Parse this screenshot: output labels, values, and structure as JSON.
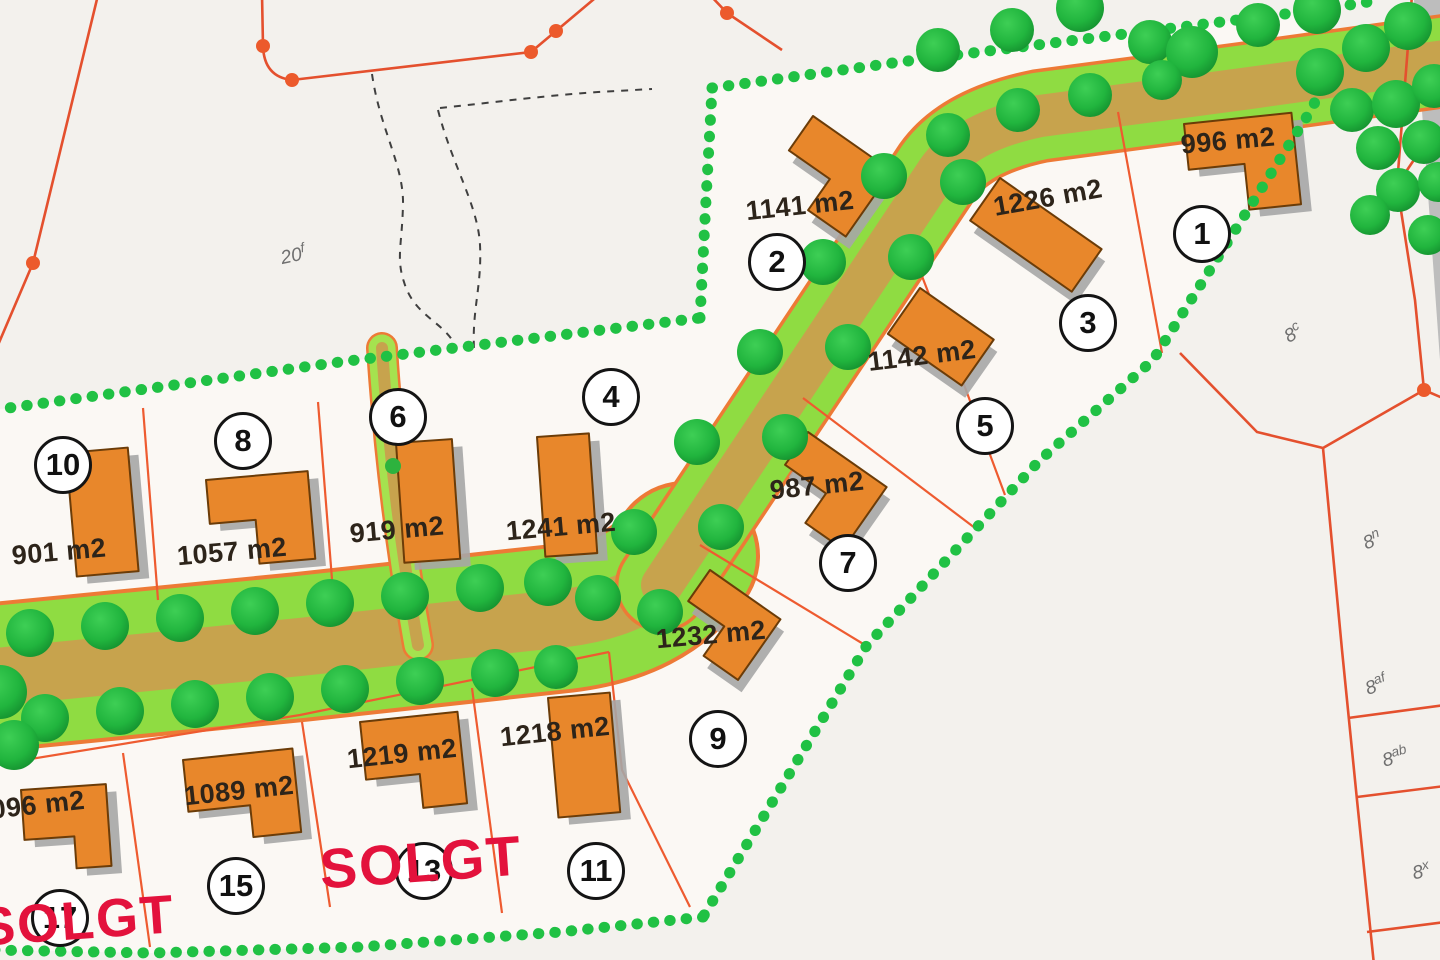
{
  "lots": [
    {
      "number": "1",
      "area": "996 m2",
      "sold": false
    },
    {
      "number": "2",
      "area": "1141 m2",
      "sold": false
    },
    {
      "number": "3",
      "area": "1226 m2",
      "sold": false
    },
    {
      "number": "4",
      "area": "1241 m2",
      "sold": false
    },
    {
      "number": "5",
      "area": "1142 m2",
      "sold": false
    },
    {
      "number": "6",
      "area": "919 m2",
      "sold": false
    },
    {
      "number": "7",
      "area": "987 m2",
      "sold": false
    },
    {
      "number": "8",
      "area": "1057 m2",
      "sold": false
    },
    {
      "number": "9",
      "area": "1232 m2",
      "sold": false
    },
    {
      "number": "10",
      "area": "901 m2",
      "sold": false
    },
    {
      "number": "11",
      "area": "1218 m2",
      "sold": false
    },
    {
      "number": "13",
      "area": "1219 m2",
      "sold": true
    },
    {
      "number": "15",
      "area": "1089 m2",
      "sold": false
    },
    {
      "number": "17",
      "area": "1096 m2",
      "sold": true
    }
  ],
  "sold_marks": [
    {
      "label": "SOLGT"
    },
    {
      "label": "SOLGT"
    }
  ],
  "parcel_labels": [
    {
      "base": "20",
      "sup": "f"
    },
    {
      "base": "8",
      "sup": "c"
    },
    {
      "base": "8",
      "sup": "n"
    },
    {
      "base": "8",
      "sup": "af"
    },
    {
      "base": "8",
      "sup": "ab"
    },
    {
      "base": "8",
      "sup": "x"
    }
  ],
  "colors": {
    "house": "#e8872b",
    "house_shadow": "#a6a6a6",
    "road_center": "#c7a34d",
    "road_verge": "#8fdc42",
    "tree": "#21b53e",
    "boundary_dots": "#20c144",
    "cadastral_line": "#e4502e",
    "sold_text": "#e3123c",
    "field_fill": "#fbf8f4"
  }
}
